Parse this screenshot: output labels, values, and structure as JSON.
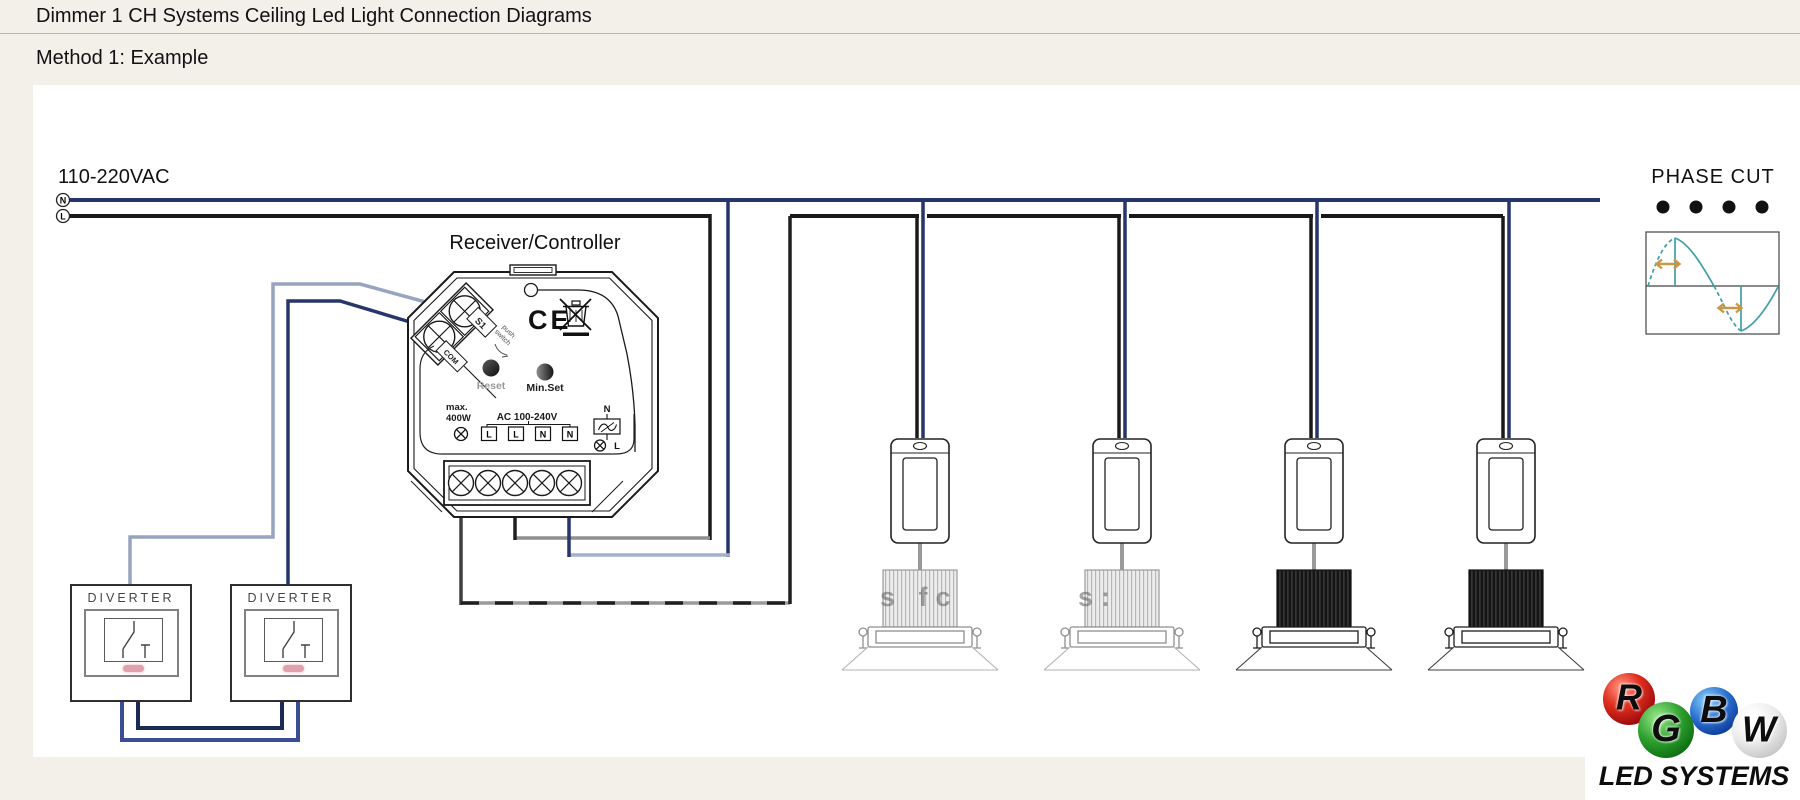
{
  "page": {
    "title": "Dimmer 1 CH Systems Ceiling Led Light Connection Diagrams",
    "subtitle": "Method 1: Example"
  },
  "supply": {
    "label": "110-220VAC",
    "neutral": "N",
    "line": "L"
  },
  "receiver": {
    "title": "Receiver/Controller",
    "s1": "S1",
    "com": "COM",
    "push_line1": "push",
    "push_line2": "switch",
    "ce_mark": "CE",
    "reset": "Reset",
    "min_set": "Min.Set",
    "max_line1": "max.",
    "max_line2": "400W",
    "ac_rating": "AC 100-240V",
    "terminals": [
      "L",
      "L",
      "N",
      "N"
    ],
    "out_n": "N",
    "out_l": "L"
  },
  "diverter": {
    "label": "DIVERTER"
  },
  "phase": {
    "title": "PHASE CUT"
  },
  "fixtures": {
    "watermark_1": "s fc",
    "watermark_2": "s:"
  },
  "logo": {
    "letters": [
      "R",
      "G",
      "B",
      "W"
    ],
    "caption": "LED SYSTEMS"
  },
  "colors": {
    "background": "#f3f0ea",
    "canvas": "#ffffff",
    "wire_neutral": "#27356a",
    "wire_line": "#1a1a1a",
    "wire_gray": "#8f8f8f",
    "wire_slate": "#a6b0ca",
    "wire_loop_outer": "#3a4d96",
    "wire_loop_inner": "#1c2a56",
    "phase_wave": "#3f9ea6",
    "phase_arrow": "#c89848",
    "indicator_pink": "#e0a0ac",
    "logo_red": "#c01818",
    "logo_green": "#1a7a1a",
    "logo_blue": "#1450b0",
    "logo_white": "#e9e9e9"
  }
}
